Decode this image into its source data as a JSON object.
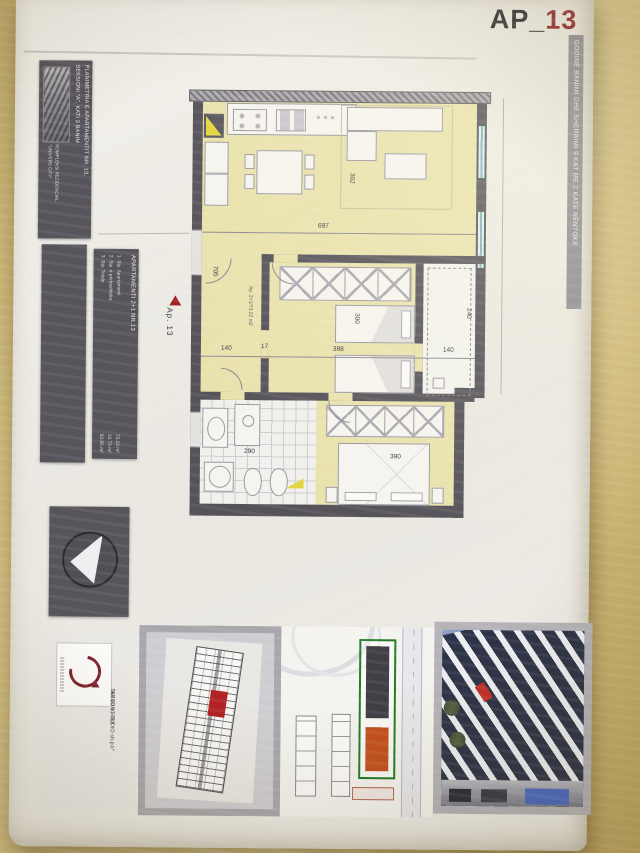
{
  "header": {
    "code_prefix": "AP_",
    "code_number": "13"
  },
  "right_banner": "GODINË BANIMI DHE SHERBIMI 9 KAT ME 2 KATE NËNTOKE",
  "title_panel": {
    "line1": "PLANIMETRIA E APARTAMENTIT NR. 13,",
    "line2": "SEKSIONI \"A\", KATI 3 BANIM",
    "complex_line1": "KOMPLEKSI REZIDENCIAL",
    "complex_line2": "\"UNIVERS CITY\""
  },
  "info_panel": {
    "title": "APARTAMENTI 2+1 NR.13",
    "rows": [
      {
        "no": "1.",
        "label": "Sip. Apartamenti",
        "value": "73.22",
        "unit": "m²"
      },
      {
        "no": "2.",
        "label": "Sip. e përbashkëta",
        "value": "10.73",
        "unit": "m²"
      },
      {
        "no": "3.",
        "label": "Sip. Totale",
        "value": "83.95",
        "unit": "m²"
      }
    ]
  },
  "marker": {
    "label": "Ap. 13"
  },
  "plan": {
    "corridor_label": "Ap. 2+1/73.22 m2",
    "kitchen_marks": "✕✕✕",
    "dims": {
      "top_width": "697",
      "living_height": "302",
      "corridor_height": "705",
      "bed1_height": "300",
      "hall_w1": "140",
      "hall_w2": "17",
      "bed1_width": "388",
      "wc_width": "140",
      "wc_height": "240",
      "bath_width": "290",
      "bed2_width": "390"
    }
  },
  "footer": {
    "studio_name": "\"ARKON STUDIO sh.p.k\"",
    "studio_phone": "067 20 90 483"
  },
  "colors": {
    "accent_red": "#8e1f26",
    "plan_floor": "#e9e2ad",
    "wall": "#55525a",
    "site_green": "#207a26",
    "site_orange": "#c2511f"
  }
}
